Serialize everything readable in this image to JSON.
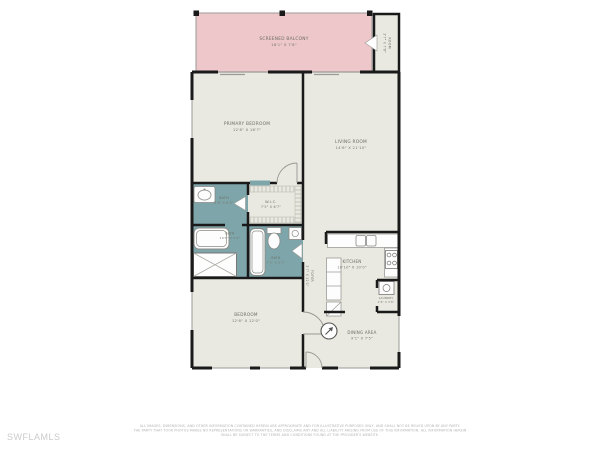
{
  "watermark": "SWFLAMLS",
  "colors": {
    "balcony_fill": "#eec7ca",
    "room_fill": "#e9e9e1",
    "bath_fill": "#7ea6aa",
    "wall": "#1a1a1a",
    "label_text": "#6c6c63",
    "watermark_text": "#cbcbcb"
  },
  "rooms": {
    "balcony": {
      "name": "SCREENED BALCONY",
      "dims": "18'1\" X 7'8\""
    },
    "side_room": {
      "name": "ROOM",
      "dims": "3'7\" X 7'8\""
    },
    "primary_bedroom": {
      "name": "PRIMARY BEDROOM",
      "dims": "12'8\" X 16'7\""
    },
    "living_room": {
      "name": "LIVING ROOM",
      "dims": "14'6\" X 21'10\""
    },
    "bath_primary": {
      "name": "BATH",
      "dims": "5'6\" X 8'5\""
    },
    "wic": {
      "name": "W.I.C.",
      "dims": "7'5\" X 6'7\""
    },
    "bath_tub": {
      "name": "BATH",
      "dims": "10'1\" X 6'4\""
    },
    "bath_guest": {
      "name": "BATH",
      "dims": "7'5\" X 5'5\""
    },
    "foyer": {
      "name": "FOYER",
      "dims": "3'7\" X 12'1\""
    },
    "kitchen": {
      "name": "KITCHEN",
      "dims": "10'10\" X 10'0\""
    },
    "laundry": {
      "name": "LAUNDRY",
      "dims": "2'6\" X 3'8\""
    },
    "dining": {
      "name": "DINING AREA",
      "dims": "9'1\" X 7'5\""
    },
    "bedroom": {
      "name": "BEDROOM",
      "dims": "12'6\" X 12'0\""
    }
  },
  "disclaimer": {
    "line1": "ALL IMAGES, DIMENSIONS, AND OTHER INFORMATION CONTAINED HEREIN ARE APPROXIMATE AND FOR ILLUSTRATIVE PURPOSES ONLY, AND SHALL NOT BE RELIED UPON BY ANY PARTY.",
    "line2": "THE PARTY THAT TOOK PHOTOS MAKES NO REPRESENTATIONS OR WARRANTIES, AND DISCLAIMS ANY AND ALL LIABILITY ARISING FROM USE OF THIS INFORMATION. ALL INFORMATION HEREIN",
    "line3": "SHALL BE SUBJECT TO THE TERMS AND CONDITIONS FOUND AT THE PROVIDER'S WEBSITE."
  }
}
